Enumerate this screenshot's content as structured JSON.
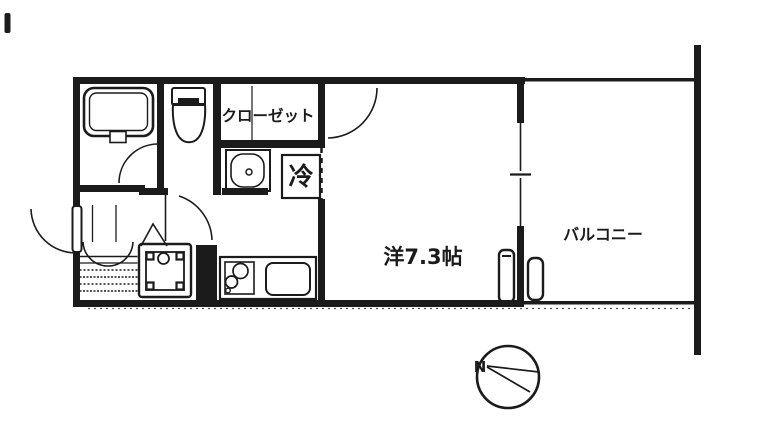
{
  "floorplan": {
    "labels": {
      "main_room": "洋7.3帖",
      "balcony": "バルコニー",
      "closet": "クローゼット",
      "refrigerator": "冷",
      "compass_north": "N"
    },
    "colors": {
      "ink": "#1b1b1b",
      "paper": "#ffffff"
    }
  }
}
